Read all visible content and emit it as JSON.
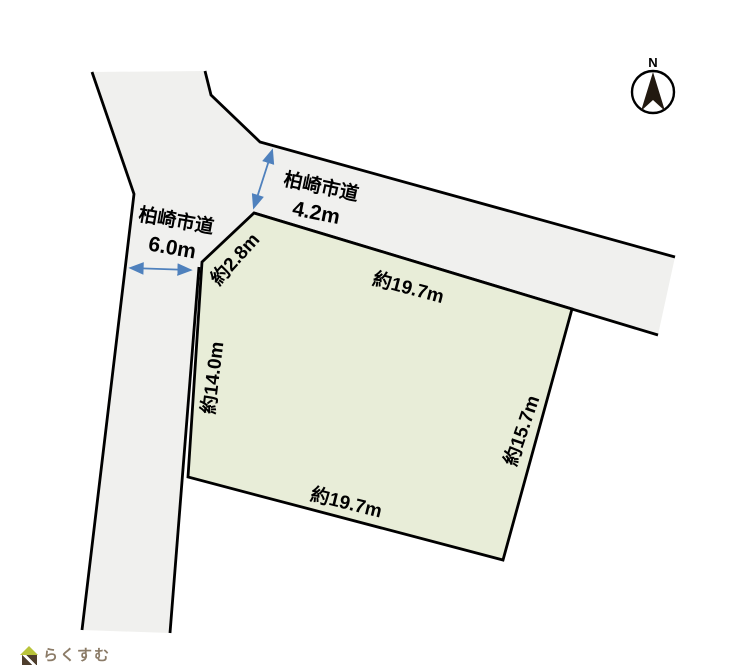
{
  "compass": {
    "label": "N"
  },
  "roads": {
    "left": {
      "name": "柏崎市道",
      "width": "6.0m"
    },
    "upper": {
      "name": "柏崎市道",
      "width": "4.2m"
    }
  },
  "plot": {
    "edge_chamfer": "約2.8m",
    "edge_top": "約19.7m",
    "edge_left": "約14.0m",
    "edge_right": "約15.7m",
    "edge_bottom": "約19.7m"
  },
  "colors": {
    "road_fill": "#f0f0ee",
    "plot_fill": "#e8edd8",
    "outline": "#000000",
    "arrow": "#4f81bd",
    "needle": "#221910"
  },
  "logo": {
    "text": "らくすむ"
  }
}
